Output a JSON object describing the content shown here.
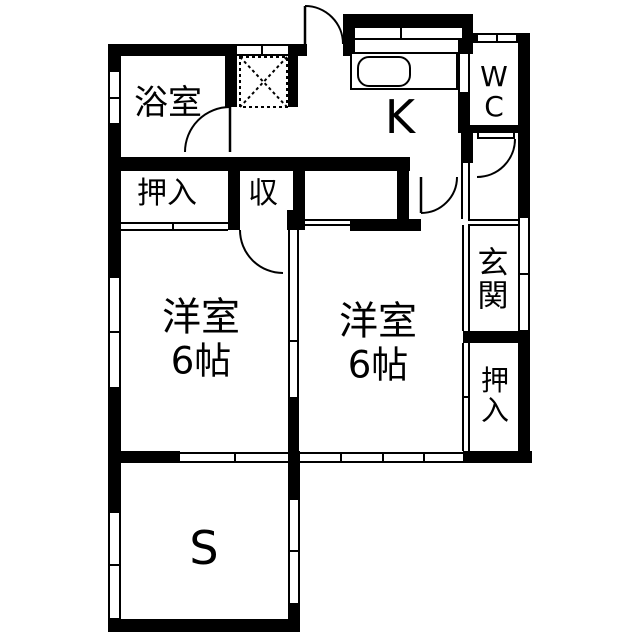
{
  "floorplan": {
    "type": "japanese-apartment-floor-plan",
    "colors": {
      "wall": "#000000",
      "background": "#ffffff",
      "line": "#000000"
    },
    "rooms": {
      "bathroom": {
        "label": "浴室"
      },
      "closet_left": {
        "label": "押入"
      },
      "storage": {
        "label": "収"
      },
      "kitchen": {
        "label": "K"
      },
      "wc": {
        "label": "WC",
        "chars": [
          "W",
          "C"
        ]
      },
      "entrance": {
        "label": "玄関",
        "chars": [
          "玄",
          "関"
        ]
      },
      "western_room_left": {
        "label": "洋室",
        "size": "6帖"
      },
      "western_room_right": {
        "label": "洋室",
        "size": "6帖"
      },
      "closet_right": {
        "label": "押入",
        "chars": [
          "押",
          "入"
        ]
      },
      "service_room": {
        "label": "S"
      }
    },
    "features": {
      "washing_machine_area": "dashed-square-with-x",
      "kitchen_sink": "counter-with-sink",
      "doors_swing": 5,
      "doors_sliding": 7,
      "windows": 9
    }
  }
}
